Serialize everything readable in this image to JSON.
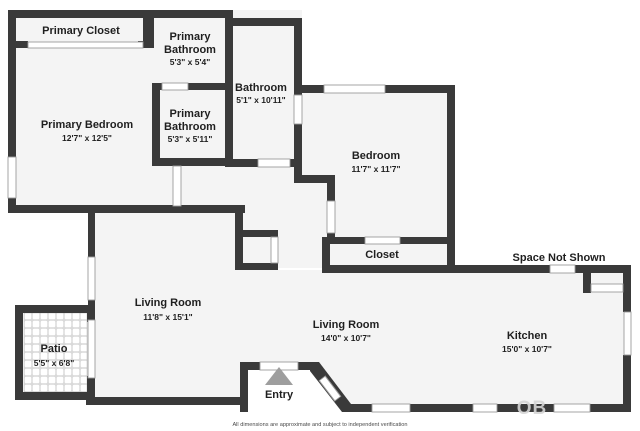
{
  "plan_title": "Apartment Floor Plan",
  "rooms": {
    "primary_closet": {
      "name": "Primary Closet"
    },
    "primary_bathroom_top": {
      "name_line1": "Primary",
      "name_line2": "Bathroom",
      "dims": "5'3\" x 5'4\""
    },
    "primary_bedroom": {
      "name": "Primary Bedroom",
      "dims": "12'7\" x 12'5\""
    },
    "primary_bathroom_lower": {
      "name_line1": "Primary",
      "name_line2": "Bathroom",
      "dims": "5'3\" x 5'11\""
    },
    "bathroom": {
      "name": "Bathroom",
      "dims": "5'1\" x 10'11\""
    },
    "bedroom": {
      "name": "Bedroom",
      "dims": "11'7\" x 11'7\""
    },
    "closet": {
      "name": "Closet"
    },
    "space_not_shown": {
      "name": "Space Not Shown"
    },
    "living_room_main": {
      "name": "Living Room",
      "dims": "11'8\" x 15'1\""
    },
    "living_room_second": {
      "name": "Living Room",
      "dims": "14'0\" x 10'7\""
    },
    "kitchen": {
      "name": "Kitchen",
      "dims": "15'0\" x 10'7\""
    },
    "patio": {
      "name": "Patio",
      "dims": "5'5\" x 6'8\""
    },
    "entry": {
      "name": "Entry"
    }
  },
  "footer": {
    "disclaimer": "All dimensions are approximate and subject to independent verification"
  },
  "watermark": {
    "text": "OB"
  },
  "colors": {
    "wall": "#3a3a3a",
    "room_fill": "#f4f4f4",
    "label_text": "#1f1f1f",
    "entry_arrow": "#9e9e9e",
    "window_outline": "#9b9b9b",
    "patio_grout": "#d9d9d9"
  }
}
